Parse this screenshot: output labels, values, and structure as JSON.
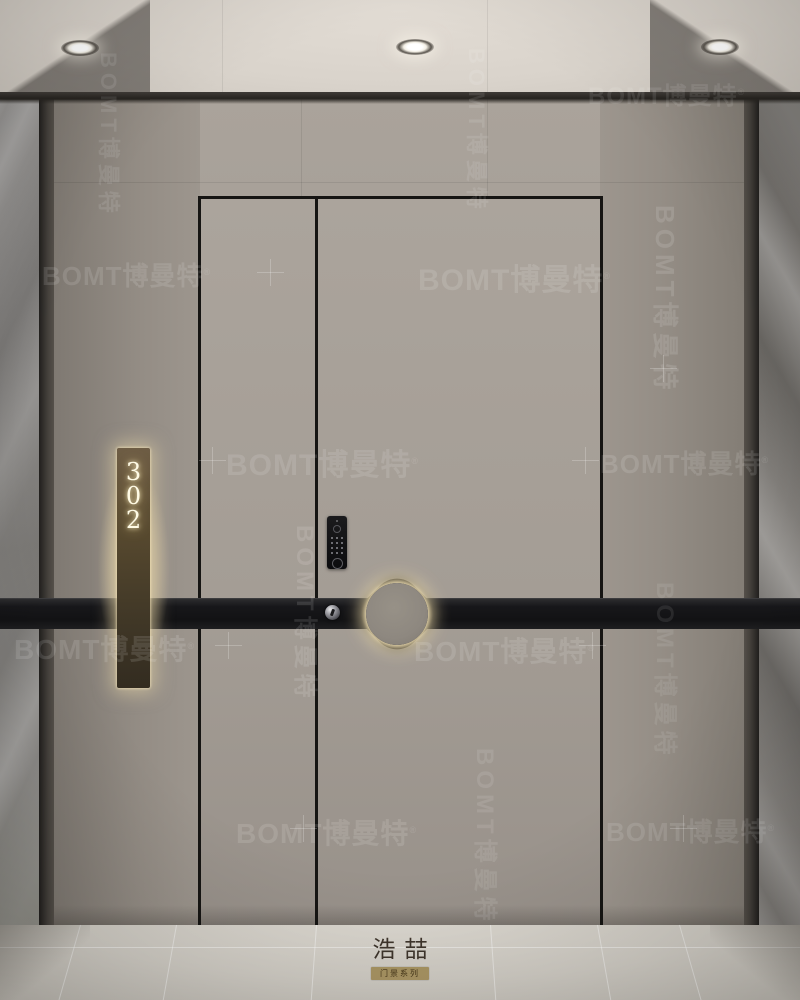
{
  "scene": {
    "description": "Modern residential entry door lobby render",
    "room_sign": {
      "number": "302",
      "digits": [
        "3",
        "0",
        "2"
      ]
    },
    "watermark": {
      "text": "BOMT博曼特",
      "reg": "®"
    },
    "brand": {
      "logo": "浩喆",
      "series": "门景系列"
    },
    "colors": {
      "wall_taupe": "#a49d95",
      "ceiling": "#d9d3cb",
      "band_black": "#141416",
      "sign_plaque_bronze": "#57492f",
      "sign_glow": "#f4e0ac",
      "marble_left": "#8b8987",
      "marble_right": "#757270",
      "floor_marble": "#d2cec6",
      "handle_ring_glow": "#ecd9a8"
    }
  }
}
